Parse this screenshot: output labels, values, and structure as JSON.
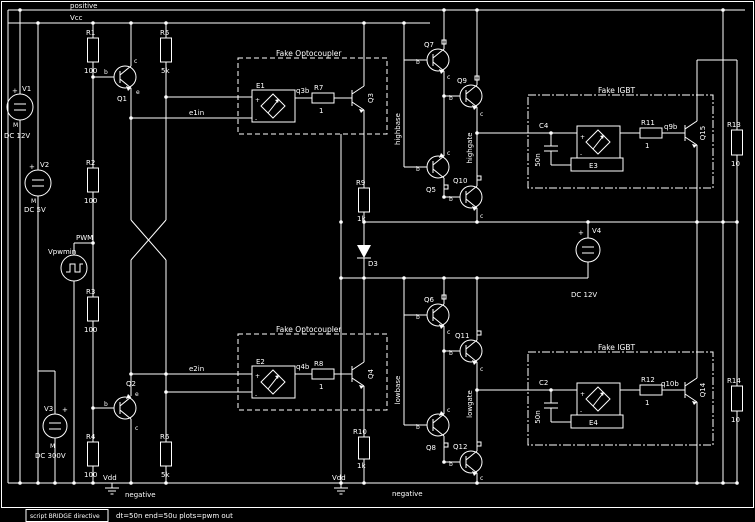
{
  "app": {
    "type": "circuit-schematic-editor"
  },
  "colors": {
    "background": "#000000",
    "foreground": "#ffffff"
  },
  "rails": {
    "positive": "positive",
    "vcc": "Vcc",
    "vdd": "Vdd",
    "negative": "negative"
  },
  "sources": {
    "v1": {
      "label": "V1",
      "value": "DC 12V"
    },
    "v2": {
      "label": "V2",
      "value": "DC 5V"
    },
    "v3": {
      "label": "V3",
      "value": "DC 300V"
    },
    "v4": {
      "label": "V4",
      "value": "DC 12V"
    },
    "vpwm": {
      "label": "Vpwmin"
    }
  },
  "marks": {
    "plus": "+",
    "minus": "M",
    "eplus": "+",
    "eminus": "-"
  },
  "resistors": {
    "r1": {
      "label": "R1",
      "value": "100"
    },
    "r2": {
      "label": "R2",
      "value": "100"
    },
    "r3": {
      "label": "R3",
      "value": "100"
    },
    "r4": {
      "label": "R4",
      "value": "100"
    },
    "r5": {
      "label": "R5",
      "value": "5k"
    },
    "r6": {
      "label": "R6",
      "value": "5k"
    },
    "r7": {
      "label": "R7",
      "value": "1"
    },
    "r8": {
      "label": "R8",
      "value": "1"
    },
    "r9": {
      "label": "R9",
      "value": "1k"
    },
    "r10": {
      "label": "R10",
      "value": "1k"
    },
    "r11": {
      "label": "R11",
      "value": "1"
    },
    "r12": {
      "label": "R12",
      "value": "1"
    },
    "r13": {
      "label": "R13",
      "value": "10"
    },
    "r14": {
      "label": "R14",
      "value": "10"
    }
  },
  "capacitors": {
    "c2": {
      "label": "C2",
      "value": "50n"
    },
    "c4": {
      "label": "C4",
      "value": "50n"
    }
  },
  "diodes": {
    "d3": {
      "label": "D3"
    }
  },
  "transistors": {
    "q1": "Q1",
    "q2": "Q2",
    "q3": "Q3",
    "q4": "Q4",
    "q5": "Q5",
    "q6": "Q6",
    "q7": "Q7",
    "q8": "Q8",
    "q9": "Q9",
    "q10": "Q10",
    "q11": "Q11",
    "q12": "Q12",
    "q14": "Q14",
    "q15": "Q15"
  },
  "pins": {
    "base": "b",
    "collector": "c",
    "emitter": "e"
  },
  "esources": {
    "e1": "E1",
    "e2": "E2",
    "e3": "E3",
    "e4": "E4"
  },
  "boxes": {
    "opto": "Fake Optocoupler",
    "igbt": "Fake IGBT"
  },
  "nets": {
    "e1in": "e1in",
    "e2in": "e2in",
    "pwm": "PWM",
    "q3b": "q3b",
    "q4b": "q4b",
    "q9b": "q9b",
    "q10b": "q10b",
    "highbase": "highbase",
    "highgate": "highgate",
    "lowbase": "lowbase",
    "lowgate": "lowgate"
  },
  "statusbar": {
    "directive": "script BRIDGE directive",
    "params": "dt=50n    end=50u    plots=pwm out"
  }
}
